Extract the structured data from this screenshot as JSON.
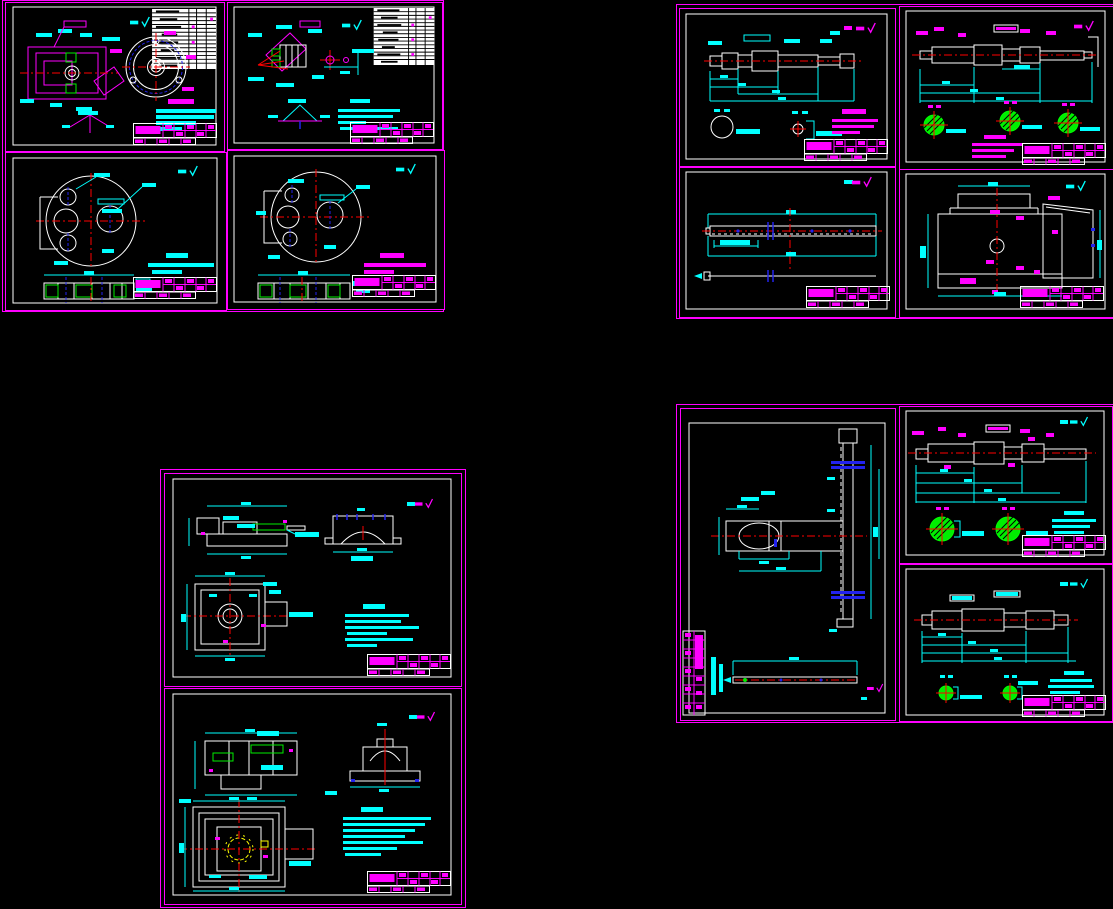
{
  "app": {
    "name": "cad-multi-sheet-drawing-view",
    "note": "Black model-space canvas showing 13 engineering drawing sheets in 4 clusters; all dimension/annotation text is below legibility at this zoom."
  },
  "palette": {
    "black": "#000000",
    "magenta": "#FF00FF",
    "cyan": "#00FFFF",
    "white": "#FFFFFF",
    "red": "#FF0000",
    "green": "#00EE00",
    "blue": "#2222EE",
    "yellow": "#FFFF00"
  },
  "clusters": [
    {
      "id": "top-left",
      "sheets": [
        {
          "id": "A1",
          "name": "fixture-assembly-with-flange-view-and-parts-list"
        },
        {
          "id": "A2",
          "name": "angled-clamp-assembly-with-parts-list"
        },
        {
          "id": "A3",
          "name": "drilled-plate-with-section-view-cyan-notes"
        },
        {
          "id": "A4",
          "name": "drilled-plate-with-section-view-magenta-notes"
        }
      ]
    },
    {
      "id": "top-right",
      "sheets": [
        {
          "id": "B1",
          "name": "stepped-shaft-with-two-section-details"
        },
        {
          "id": "B2",
          "name": "stepped-shaft-with-three-green-section-circles"
        },
        {
          "id": "B3",
          "name": "long-rack-bar-two-views"
        },
        {
          "id": "B4",
          "name": "housing-front-and-side-view"
        }
      ]
    },
    {
      "id": "bottom-left",
      "sheets": [
        {
          "id": "C1",
          "name": "slide-bracket-three-views-with-notes"
        },
        {
          "id": "C2",
          "name": "gear-housing-three-views-with-notes"
        }
      ]
    },
    {
      "id": "bottom-right",
      "sheets": [
        {
          "id": "D1",
          "name": "vertical-rack-and-arm-portrait-sheet"
        },
        {
          "id": "D2",
          "name": "stepped-shaft-with-two-large-green-sections"
        },
        {
          "id": "D3",
          "name": "stepped-shaft-with-two-small-green-sections"
        }
      ]
    }
  ]
}
